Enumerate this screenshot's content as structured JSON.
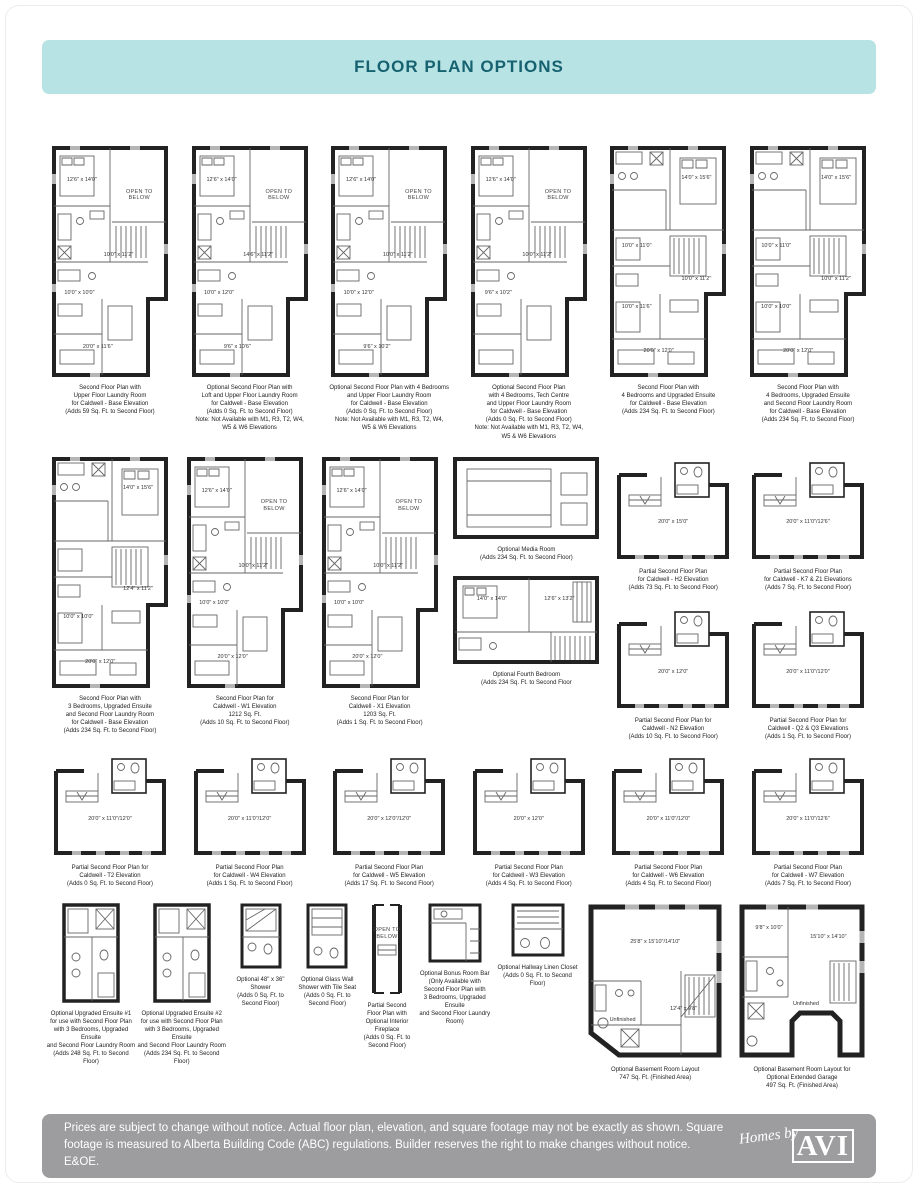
{
  "header": {
    "title": "FLOOR PLAN OPTIONS"
  },
  "labels": {
    "open_to_below": "OPEN TO\nBELOW",
    "unfinished": "Unfinished"
  },
  "colors": {
    "header_bg": "#b8e3e5",
    "header_text": "#176270",
    "footer_bg": "#9d9da0",
    "wall_line": "#222222"
  },
  "row1": [
    {
      "caption": "Second Floor Plan with\nUpper Floor Laundry Room\nfor Caldwell - Base Elevation\n(Adds 59 Sq. Ft. to Second Floor)",
      "rooms": [
        "12'6\" x 14'0\"",
        "10'0\" x 11'2\"",
        "10'0\" x 10'0\"",
        "20'0\" x 11'6\""
      ]
    },
    {
      "caption": "Optional Second Floor Plan with\nLoft and Upper Floor Laundry Room\nfor Caldwell - Base Elevation\n(Adds 0 Sq. Ft. to Second Floor)\nNote: Not Available with M1, R3, T2, W4,\nW5 & W6 Elevations",
      "rooms": [
        "12'6\" x 14'0\"",
        "14'6\" x 11'2\"",
        "10'0\" x 12'0\"",
        "9'6\" x 10'6\""
      ]
    },
    {
      "caption": "Optional Second Floor Plan with 4 Bedrooms\nand Upper Floor Laundry Room\nfor Caldwell - Base Elevation\n(Adds 0 Sq. Ft. to Second Floor)\nNote: Not Available with M1, R3, T2, W4,\nW5 & W6 Elevations",
      "rooms": [
        "12'6\" x 14'0\"",
        "10'0\" x 11'2\"",
        "10'0\" x 12'0\"",
        "9'6\" x 10'2\""
      ]
    },
    {
      "caption": "Optional Second Floor Plan\nwith 4 Bedrooms, Tech Centre\nand Upper Floor Laundry Room\nfor Caldwell - Base Elevation\n(Adds 0 Sq. Ft. to Second Floor)\nNote: Not Available with M1, R3, T2, W4,\nW5 & W6 Elevations",
      "rooms": [
        "12'6\" x 14'0\"",
        "10'0\" x 11'2\"",
        "9'6\" x 10'2\"",
        ""
      ]
    },
    {
      "caption": "Second Floor Plan with\n4 Bedrooms and Upgraded Ensuite\nfor Caldwell - Base Elevation\n(Adds 234 Sq. Ft. to Second Floor)",
      "rooms": [
        "14'0\" x 15'6\"",
        "10'0\" x 11'0\"",
        "10'0\" x 11'2\"",
        "10'0\" x 11'6\"",
        "20'0\" x 12'0\""
      ]
    },
    {
      "caption": "Second Floor Plan with\n4 Bedrooms, Upgraded Ensuite\nand Second Floor Laundry Room\nfor Caldwell - Base Elevation\n(Adds 234 Sq. Ft. to Second Floor)",
      "rooms": [
        "14'0\" x 15'6\"",
        "10'0\" x 11'0\"",
        "10'0\" x 11'2\"",
        "10'0\" x 10'0\"",
        "20'0\" x 12'0\""
      ]
    }
  ],
  "row2": [
    {
      "caption": "Second Floor Plan with\n3 Bedrooms, Upgraded Ensuite\nand Second Floor Laundry Room\nfor Caldwell - Base Elevation\n(Adds 234 Sq. Ft. to Second Floor)",
      "rooms": [
        "14'0\" x 15'6\"",
        "",
        "12'4\" x 11'2\"",
        "10'0\" x 10'0\"",
        "20'0\" x 12'0\""
      ]
    },
    {
      "caption": "Second Floor Plan for\nCaldwell - W1 Elevation\n1212 Sq. Ft.\n(Adds 10 Sq. Ft. to Second Floor)",
      "rooms": [
        "12'6\" x 14'0\"",
        "10'0\" x 11'2\"",
        "10'0\" x 10'0\"",
        "20'0\" x 12'0\""
      ]
    },
    {
      "caption": "Second Floor Plan for\nCaldwell - X1 Elevation\n1203 Sq. Ft.\n(Adds 1 Sq. Ft. to Second Floor)",
      "rooms": [
        "12'6\" x 14'0\"",
        "10'0\" x 11'2\"",
        "10'0\" x 10'0\"",
        "20'0\" x 12'0\""
      ]
    },
    {
      "top": {
        "caption": "Optional Media Room\n(Adds 234 Sq. Ft. to Second Floor)"
      },
      "bottom": {
        "caption": "Optional Fourth Bedroom\n(Adds 234 Sq. Ft. to Second Floor",
        "rooms": [
          "14'0\" x 14'0\"",
          "12'6\" x 13'2\""
        ]
      }
    },
    {
      "top": {
        "caption": "Partial Second Floor Plan\nfor Caldwell - H2 Elevation\n(Adds 73 Sq. Ft. to Second Floor)",
        "rooms": [
          "20'0\" x 15'0\""
        ]
      },
      "bottom": {
        "caption": "Partial Second Floor Plan for\nCaldwell - N2 Elevation\n(Adds 10 Sq. Ft. to Second Floor)",
        "rooms": [
          "20'0\" x 12'0\""
        ]
      }
    },
    {
      "top": {
        "caption": "Partial Second Floor Plan\nfor Caldwell - K7 & Z1 Elevations\n(Adds 7 Sq. Ft. to Second Floor)",
        "rooms": [
          "20'0\" x 11'0\"/12'6\""
        ]
      },
      "bottom": {
        "caption": "Partial Second Floor Plan for\nCaldwell - Q2 & Q3 Elevations\n(Adds 1 Sq. Ft. to Second Floor)",
        "rooms": [
          "20'0\" x 11'0\"/12'0\""
        ]
      }
    }
  ],
  "row3": [
    {
      "caption": "Partial Second Floor Plan for\nCaldwell - T2 Elevation\n(Adds 0 Sq. Ft. to Second Floor)",
      "rooms": [
        "20'0\" x 11'0\"/12'0\""
      ]
    },
    {
      "caption": "Partial Second Floor Plan\nfor Caldwell - W4 Elevation\n(Adds 1 Sq. Ft. to Second Floor)",
      "rooms": [
        "20'0\" x 11'0\"/12'0\""
      ]
    },
    {
      "caption": "Partial Second Floor Plan\nfor Caldwell - W5 Elevation\n(Adds 17 Sq. Ft. to Second Floor)",
      "rooms": [
        "20'0\" x 12'0\"/12'0\""
      ]
    },
    {
      "caption": "Partial Second Floor Plan\nfor Caldwell - W3 Elevation\n(Adds 4 Sq. Ft. to Second Floor)",
      "rooms": [
        "20'0\" x 12'0\""
      ]
    },
    {
      "caption": "Partial Second Floor Plan\nfor Caldwell - W6 Elevation\n(Adds 4 Sq. Ft. to Second Floor)",
      "rooms": [
        "20'0\" x 11'0\"/12'0\""
      ]
    },
    {
      "caption": "Partial Second Floor Plan\nfor Caldwell - W7 Elevation\n(Adds 7 Sq. Ft. to Second Floor)",
      "rooms": [
        "20'0\" x 11'0\"/12'6\""
      ]
    }
  ],
  "row4": [
    {
      "caption": "Optional Upgraded Ensuite #1\nfor use with Second Floor Plan\nwith 3 Bedrooms, Upgraded Ensuite\nand Second Floor Laundry Room\n(Adds 248 Sq. Ft. to Second Floor)"
    },
    {
      "caption": "Optional Upgraded Ensuite #2\nfor use with Second Floor Plan\nwith 3 Bedrooms, Upgraded Ensuite\nand Second Floor Laundry Room\n(Adds 234 Sq. Ft. to Second Floor)"
    },
    {
      "caption": "Optional 48\" x 36\" Shower\n(Adds 0 Sq. Ft. to\nSecond Floor)"
    },
    {
      "caption": "Optional Glass Wall\nShower with Tile Seat\n(Adds 0 Sq. Ft. to\nSecond Floor)"
    },
    {
      "caption": "Partial Second Floor Plan with\nOptional Interior Fireplace\n(Adds 0 Sq. Ft. to\nSecond Floor)"
    },
    {
      "caption": "Optional Bonus Room Bar\n(Only Available with\nSecond Floor Plan with\n3 Bedrooms, Upgraded Ensuite\nand Second Floor Laundry Room)"
    },
    {
      "caption": "Optional Hallway Linen Closet\n(Adds 0 Sq. Ft. to Second Floor)"
    },
    {
      "caption": "Optional Basement Room Layout\n747 Sq. Ft. (Finished Area)",
      "rooms": [
        "25'8\" x 15'10\"/14'10\"",
        "Unfinished",
        "12'4\" x 9'8\""
      ]
    },
    {
      "caption": "Optional Basement Room Layout for\nOptional Extended Garage\n497 Sq. Ft. (Finished Area)",
      "rooms": [
        "9'8\" x 10'0\"",
        "15'10\" x 14'10\"",
        "Unfinished"
      ]
    }
  ],
  "footer": {
    "disclaimer": "Prices are subject to change without notice. Actual floor plan, elevation, and square footage may not be exactly as shown. Square footage is measured to Alberta Building Code (ABC) regulations. Builder reserves the right to make changes without notice. E&OE.",
    "logo_script": "Homes by",
    "logo_name": "AVI"
  }
}
